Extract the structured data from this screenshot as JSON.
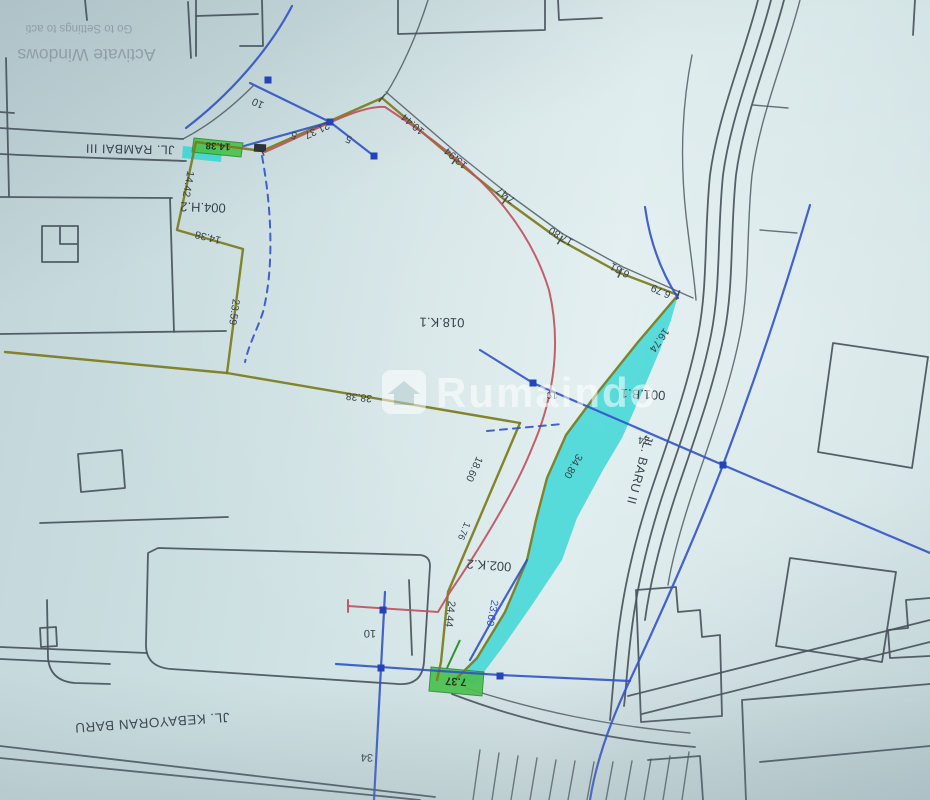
{
  "colors": {
    "bg1": "#ccdfe1",
    "bg2": "#dcebec",
    "bg3": "#c2d6da",
    "ink": "#49535c",
    "olive": "#7d7d20",
    "blue": "#3152c8",
    "blue_node": "#2443b8",
    "red": "#c04f5e",
    "cyan": "#35d6d4",
    "green": "#49c24f",
    "green_edge": "#2e8f33",
    "label": "#39424d",
    "system_text": "#8d9aa6",
    "watermark": "#ffffff"
  },
  "system_overlay": {
    "line1": "Activate Windows",
    "line2": "Go to Settings to acti"
  },
  "watermark": {
    "text": "Rumaindo"
  },
  "roads": {
    "rambai": "JL. RAMBAI III",
    "kebayoran": "JL. KEBAYORAN BARU",
    "baru": "JL. BARU II"
  },
  "parcels": {
    "p004": "004.H.2",
    "p018": "018.K.1",
    "p001": "001.B.1",
    "p002": "002.K.2"
  },
  "measurements": {
    "top_10": "10",
    "top_5": "5",
    "m5b": "5",
    "m21_37": "21.37",
    "m10_44": "10.44",
    "m13_94": "13.94",
    "m7_47": "7.47",
    "m17_80": "17.80",
    "m6_81": "6.81",
    "m6_79": "6.79",
    "m16_74": "16.74",
    "m34_80": "34.80",
    "m23_59": "23.59",
    "m38_38": "38.38",
    "m18_60": "18.60",
    "m1_76": "1.76",
    "m24_44": "24.44",
    "m23_60": "23.60",
    "m24": "24",
    "m19": "19",
    "m14_38_a": "14.38",
    "m14_42": "14.42",
    "m14_38_b": "14.38",
    "m7_37": "7.37",
    "bottom_10": "10",
    "bottom_34": "34"
  }
}
